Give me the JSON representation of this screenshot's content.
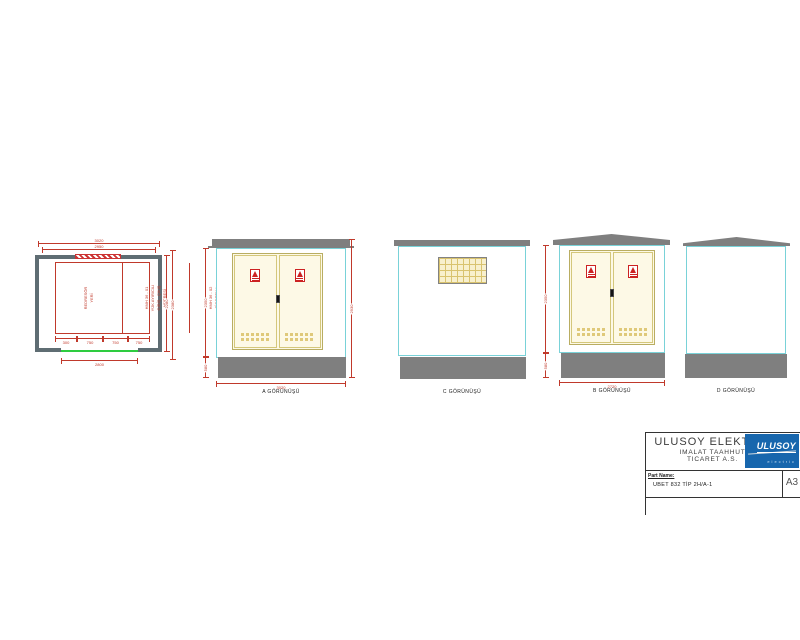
{
  "drawing": {
    "plan": {
      "cells": [
        {
          "text": "REDRESÖR\nYERİ"
        },
        {
          "text": "HMH 36 - 01\nYÜK AYIRICILI\nGİRİŞ - ÇIKIŞ\nHÜCRESİ"
        },
        {
          "text": "HMH 36 - 02\nSİGORTALI\nYÜK AYIRICILI\nTRAFO KORUMA\nHÜCRESİ"
        },
        {
          "text": "HMH 36 - 01\nYÜK AYIRICILI\nGİRİŞ - ÇIKIŞ\nHÜCRESİ"
        }
      ],
      "dims": {
        "top_outer": "3020",
        "top_inner": "2950",
        "right_outer": "2380",
        "right_inner": "2280",
        "bottom": "2800",
        "chain": [
          "300",
          "750",
          "750",
          "750"
        ]
      }
    },
    "views": {
      "a": {
        "label": "A GÖRÜNÜŞÜ",
        "dims": {
          "height": "2350",
          "base": "580",
          "total": "2930",
          "width": "3020"
        }
      },
      "c": {
        "label": "C GÖRÜNÜŞÜ"
      },
      "b": {
        "label": "B GÖRÜNÜŞÜ",
        "dims": {
          "height": "2350",
          "base": "580",
          "width": "2720"
        }
      },
      "d": {
        "label": "D GÖRÜNÜŞÜ"
      }
    }
  },
  "title_block": {
    "company_line1": "ULUSOY ELEKTRIK",
    "company_line2": "IMALAT TAAHHUT",
    "company_line3": "TICARET A.S.",
    "logo_text": "ULUSOY",
    "logo_subtext": "electric",
    "part_name_label": "Part Name:",
    "part_name_value": "UBET 832 TİP 2H/A-1",
    "sheet_size": "A3"
  },
  "colors": {
    "wall_slate": "#5f6d73",
    "concrete_gray": "#7f7f7f",
    "outline_cyan": "#79d2d8",
    "door_cream": "#fdf9e6",
    "door_line": "#d4c77b",
    "vent_yellow": "#dfc97a",
    "dimension_red": "#c0392b",
    "opening_green": "#2ecc40",
    "logo_blue": "#1766ad",
    "sign_red": "#cc2222"
  }
}
